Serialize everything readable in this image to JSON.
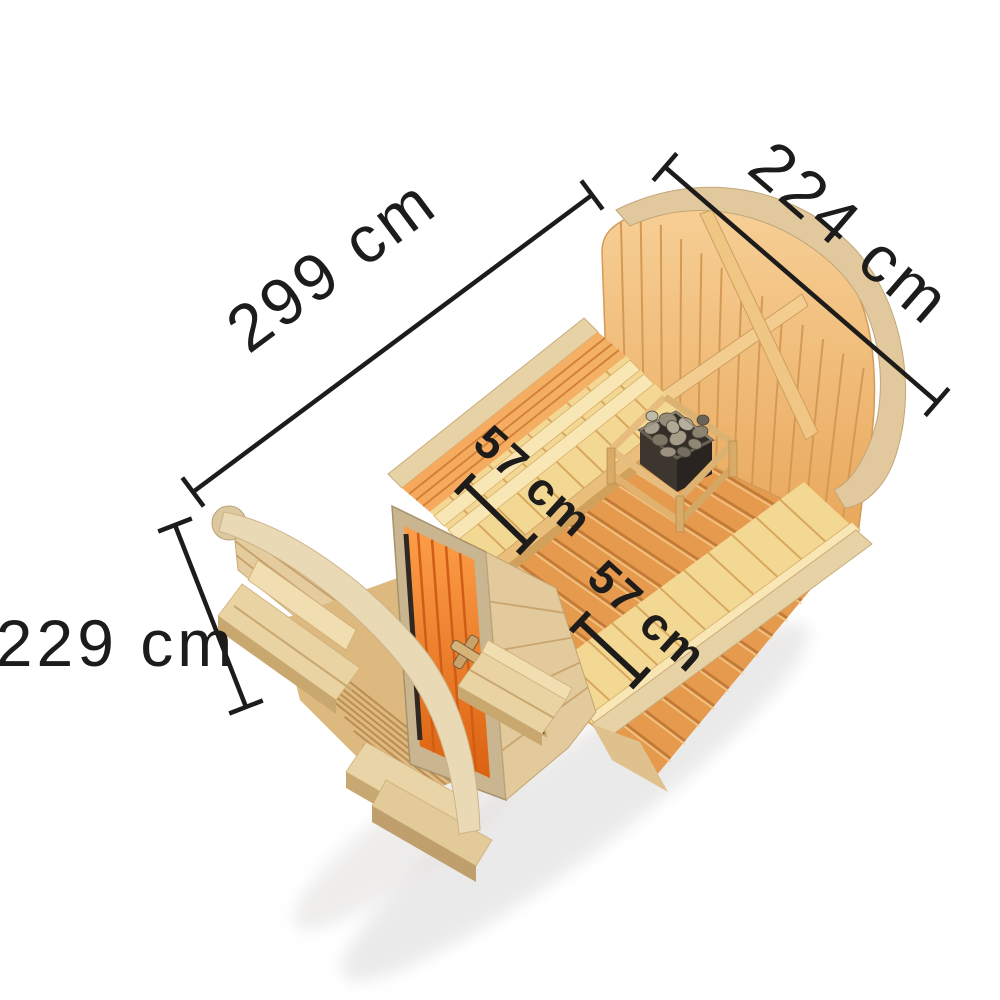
{
  "meta": {
    "title": "Barrel sauna dimensional diagram",
    "view": "top oblique product render on white background",
    "background": "#ffffff",
    "unit": "cm"
  },
  "dimensions": {
    "length": {
      "value": 299,
      "unit": "cm",
      "label": "299 cm",
      "measures": "sauna body length, upper-left diagonal"
    },
    "width": {
      "value": 224,
      "unit": "cm",
      "label": "224 cm",
      "measures": "sauna body width, upper-right diagonal"
    },
    "height": {
      "value": 229,
      "unit": "cm",
      "label": "229 cm",
      "measures": "sauna height, left side"
    },
    "bench_left": {
      "value": 57,
      "unit": "cm",
      "label": "57 cm",
      "measures": "left interior bench depth"
    },
    "bench_right": {
      "value": 57,
      "unit": "cm",
      "label": "57 cm",
      "measures": "right interior bench depth"
    }
  },
  "colors": {
    "dimension_text": "#1d1c1a",
    "dimension_line": "#1d1c1a",
    "door_glass": "#f07c24",
    "floor_wood": "#e59a4d",
    "bench_wood": "#f3d893",
    "wall_wood": "#ef9e4f",
    "gable_wood": "#f2bf7d",
    "pale_wood": "#e7d2a6",
    "arc_wood": "#e1c89d",
    "stone_gray": "#9a9180"
  },
  "scene": {
    "subject": "wooden barrel sauna, roof removed to show interior",
    "parts": [
      "rear gable wall",
      "roof arch rib",
      "front arch rib",
      "left bench with backrest",
      "right bench",
      "sauna heater with stones",
      "plank floor",
      "orange glass door",
      "porch deck",
      "porch bench left",
      "porch bench right",
      "entry steps"
    ]
  }
}
